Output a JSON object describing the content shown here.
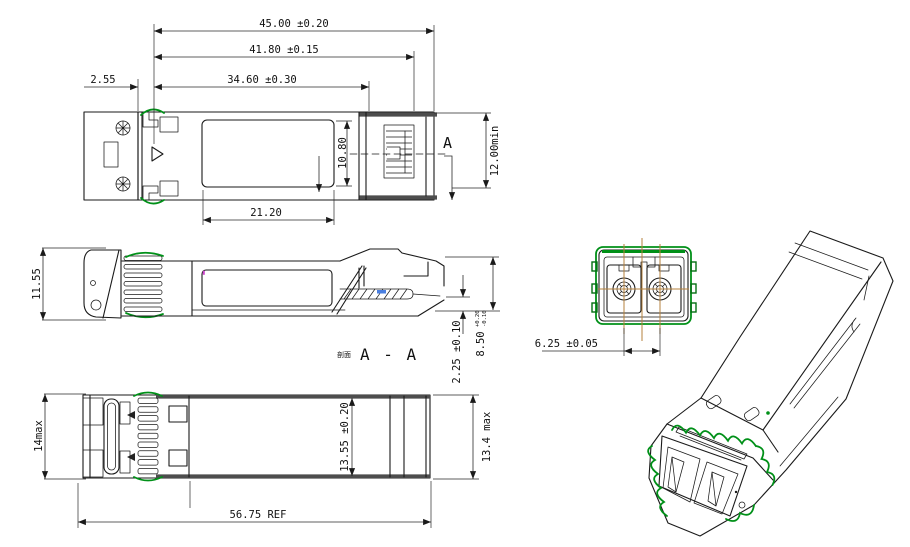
{
  "drawing_type": "SFP transceiver mechanical outline drawing",
  "dimensions": {
    "top_view": {
      "overall_length": "45.00 ±0.20",
      "length_to_latch": "41.80 ±0.15",
      "body_length": "34.60 ±0.30",
      "bezel_offset": "2.55",
      "label_length": "21.20",
      "label_width": "10.80",
      "min_width": "12.00min",
      "section_marker": "A"
    },
    "side_view": {
      "height": "11.55",
      "pcb_thickness": "2.25 ±0.10",
      "nose_height": "8.50",
      "nose_height_tol_plus": "+0.20",
      "nose_height_tol_minus": "-0.10",
      "section_label_prefix": "剖面",
      "section_label": "A - A"
    },
    "bottom_view": {
      "front_height": "14max",
      "body_width": "13.55 ±0.20",
      "max_width": "13.4 max",
      "overall_ref_length": "56.75 REF"
    },
    "front_view": {
      "port_pitch": "6.25 ±0.05"
    }
  },
  "colors": {
    "line": "#1a1a1a",
    "emi_gasket_green": "#009018",
    "centerline_orange": "#b5823c",
    "highlight_blue": "#4a7fe0",
    "accent_magenta": "#cc44cc",
    "background": "#ffffff"
  }
}
